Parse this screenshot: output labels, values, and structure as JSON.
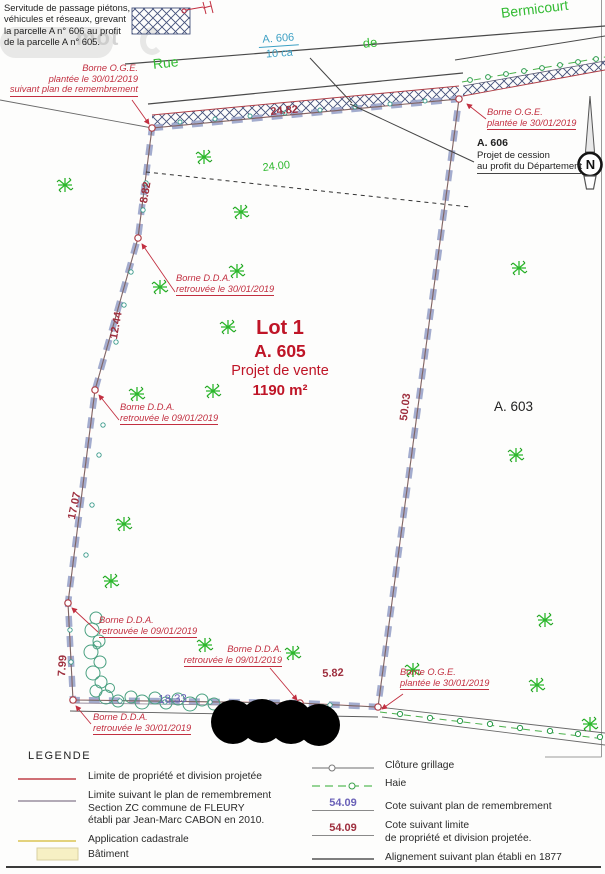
{
  "watermark": {
    "text": "mot"
  },
  "servitude_note": {
    "lines": [
      "Servitude de passage piétons,",
      "véhicules et réseaux, grevant",
      "la parcelle A n° 606 au profit",
      "de la parcelle A n° 605."
    ]
  },
  "street": {
    "rue": "Rue",
    "de": "de",
    "bermicourt": "Bermicourt"
  },
  "parcel_a606": {
    "label": "A. 606",
    "area": "10 ca"
  },
  "cession_note": {
    "title": "A. 606",
    "lines": [
      "Projet de cession",
      "au profit du Département"
    ]
  },
  "parcel_a603": {
    "label": "A. 603"
  },
  "lot1": {
    "title": "Lot 1",
    "parcel": "A. 605",
    "subtitle": "Projet de vente",
    "area": "1190 m²"
  },
  "north": {
    "label": "N"
  },
  "measurements": {
    "top": "24.82",
    "top_cadastre": "24.00",
    "left_1": "8.82",
    "left_2": "12.44",
    "left_3": "17.07",
    "left_4": "7.99",
    "right": "50.03",
    "bottom_left": "18.33",
    "bottom_right": "5.82"
  },
  "bornes": [
    {
      "lines": [
        "Borne O.G.E.",
        "plantée le 30/01/2019",
        "suivant plan de remembrement"
      ]
    },
    {
      "lines": [
        "Borne O.G.E.",
        "plantée le 30/01/2019"
      ]
    },
    {
      "lines": [
        "Borne D.D.A.",
        "retrouvée le 30/01/2019"
      ]
    },
    {
      "lines": [
        "Borne D.D.A.",
        "retrouvée le 09/01/2019"
      ]
    },
    {
      "lines": [
        "Borne D.D.A.",
        "retrouvée le 09/01/2019"
      ]
    },
    {
      "lines": [
        "Borne D.D.A.",
        "retrouvée le 09/01/2019"
      ]
    },
    {
      "lines": [
        "Borne O.G.E.",
        "plantée le 30/01/2019"
      ]
    },
    {
      "lines": [
        "Borne D.D.A.",
        "retrouvée le 30/01/2019"
      ]
    }
  ],
  "legend": {
    "title": "LEGENDE",
    "left": [
      {
        "label_lines": [
          "Limite de propriété et division projetée"
        ]
      },
      {
        "label_lines": [
          "Limite suivant le plan de remembrement",
          "Section ZC commune de FLEURY",
          "établi par Jean-Marc CABON en 2010."
        ]
      },
      {
        "label_lines": [
          "Application cadastrale"
        ]
      },
      {
        "label_lines": [
          "Bâtiment"
        ]
      }
    ],
    "right": [
      {
        "label_lines": [
          "Clôture grillage"
        ]
      },
      {
        "label_lines": [
          "Haie"
        ]
      },
      {
        "value": "54.09",
        "label_lines": [
          "Cote suivant plan de remembrement"
        ]
      },
      {
        "value": "54.09",
        "label_lines": [
          "Cote suivant limite",
          "de propriété et division projetée."
        ]
      },
      {
        "label_lines": [
          "Alignement suivant plan établi en 1877"
        ]
      }
    ]
  },
  "colors": {
    "annotation_red": "#c22f40",
    "measure_red": "#9e2f3e",
    "cadastre_green": "#2eb82e",
    "street_green": "#33bb33",
    "cadastre_blue": "#3da0c4",
    "cote_violet": "#6b62b8",
    "lot_red": "#bf1527",
    "dash_lavender": "#9ba5ca"
  }
}
